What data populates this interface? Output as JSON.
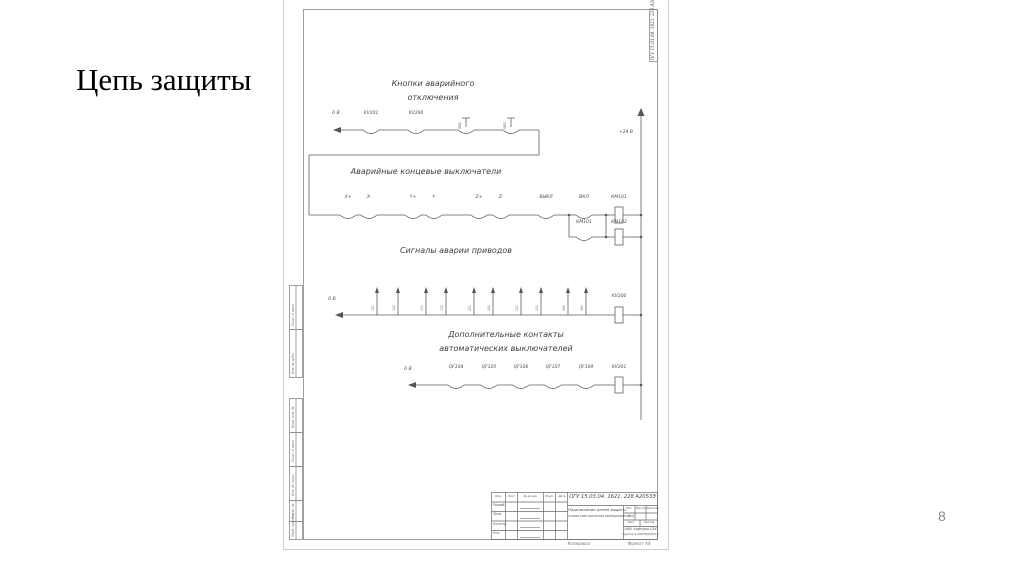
{
  "slide": {
    "title": "Цепь защиты",
    "page_number": "8"
  },
  "colors": {
    "line": "#5f5f5f",
    "text": "#4a4a4a",
    "sheet_border": "#cfcfcf"
  },
  "frame": {
    "corner_code": "ОГУ 15.03.04. 1621. 228 А2053Э",
    "side_labels": [
      "Подп. и дата",
      "Инв. № дубл.",
      "Взам. инв. №",
      "Подп. и дата",
      "Инв. № подл.",
      "Справ. №",
      "Перв. примен."
    ]
  },
  "schematic": {
    "bus_label": "+24 В",
    "buttons": {
      "title1": "Кнопки аварийного",
      "title2": "отключения",
      "zero": "0 В",
      "relay1": "KV201",
      "relay2": "KV200",
      "sb1": "SB1",
      "sb2": "SB2"
    },
    "limits": {
      "title": "Аварийные концевые выключатели",
      "c": [
        "X+",
        "X-",
        "Y+",
        "Y-",
        "Z+",
        "Z-",
        "ВЫКЛ",
        "ВКЛ"
      ],
      "coil1": "КМ101",
      "branch": "КМ101",
      "coil2": "КМ102"
    },
    "alarms": {
      "title": "Сигналы аварии приводов",
      "zero": "0 В",
      "coil": "KV200",
      "s": [
        "101",
        "102",
        "151",
        "152",
        "201",
        "202",
        "251",
        "252",
        "380",
        "381"
      ]
    },
    "breakers": {
      "title1": "Дополнительные контакты",
      "title2": "автоматических выключателей",
      "zero": "0 В",
      "c": [
        "QF104",
        "QF105",
        "QF106",
        "QF107",
        "QF109"
      ],
      "coil": "KV201"
    }
  },
  "title_block": {
    "doc_code": "ОГУ 15.03.04. 1621. 228 А2053Э",
    "name1": "Подключение цепей защиты",
    "name2": "(схема электрическая принципиальная)",
    "header": [
      "Изм.",
      "Лист",
      "№ докум.",
      "Подп.",
      "Дата"
    ],
    "roles": [
      "Разраб.",
      "Пров.",
      "Н.контр.",
      "Утв."
    ],
    "lit": [
      "Лит.",
      "Масса",
      "Масштаб"
    ],
    "lit_value": "У",
    "sheet_labels": [
      "Лист",
      "Листов"
    ],
    "org1": "АКИ, кафедра САУ",
    "org2": "группа З-16АТВ(б)ОП-2",
    "copied": "Копировал",
    "format": "Формат А4"
  }
}
